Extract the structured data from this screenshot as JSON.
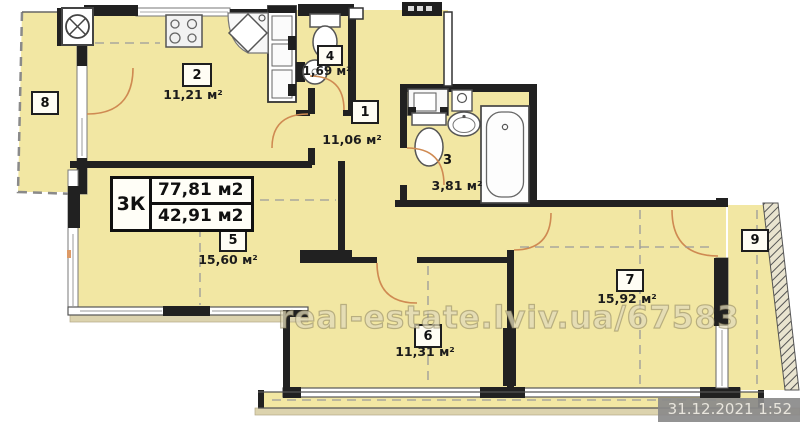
{
  "summary": {
    "type_label": "3К",
    "total_area": "77,81 м2",
    "living_area": "42,91 м2"
  },
  "rooms": [
    {
      "number": "1",
      "area": "11,06 м²"
    },
    {
      "number": "2",
      "area": "11,21 м²"
    },
    {
      "number": "3",
      "area": "3,81 м²"
    },
    {
      "number": "4",
      "area": "1,69 м²"
    },
    {
      "number": "5",
      "area": "15,60 м²"
    },
    {
      "number": "6",
      "area": "11,31 м²"
    },
    {
      "number": "7",
      "area": "15,92 м²"
    },
    {
      "number": "8",
      "area": ""
    },
    {
      "number": "9",
      "area": ""
    }
  ],
  "watermark": "real-estate.lviv.ua/67583",
  "timestamp": "31.12.2021 1:52",
  "colors": {
    "room_fill": "#f2e7a3",
    "wall": "#212121",
    "window_band": "#ffffff",
    "door_arc": "#cf8a52",
    "dash_line": "#999999",
    "slab_strip": "#dcd3ae",
    "watermark": "#f7f1d0",
    "timestamp_bg": "#8a8a8a"
  }
}
